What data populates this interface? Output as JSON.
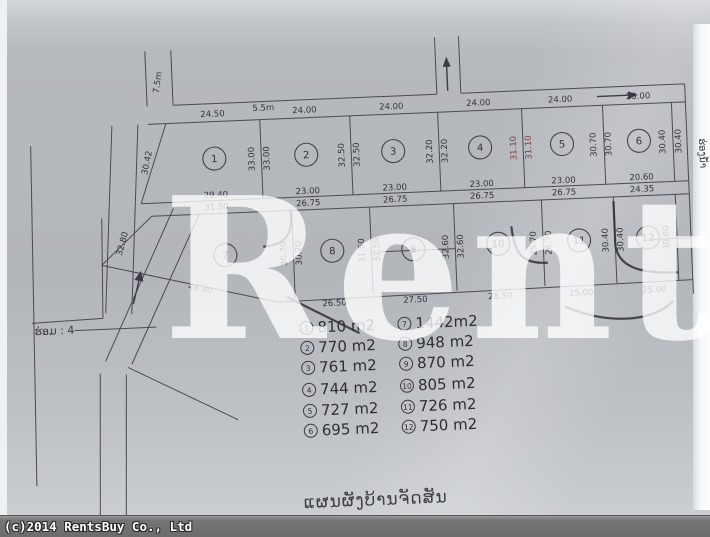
{
  "window": {
    "copyright": "(c)2014 RentsBuy Co., Ltd"
  },
  "watermark": {
    "text": "Rents"
  },
  "plan": {
    "caption": "ແຜນຜັງບ້ານຈັດສັນ",
    "alley_label": "ຮ່ອມ : 4",
    "canal_label": "ຮ່ອງນ້ຳ",
    "plot_numbers": [
      "1",
      "2",
      "3",
      "4",
      "5",
      "6",
      "7",
      "8",
      "9",
      "10",
      "11",
      "12"
    ],
    "dim_labels": [
      "7.5m",
      "24.50",
      "5.5m",
      "24.00",
      "24.00",
      "24.00",
      "24.00",
      "25.00",
      "30.42",
      "33.00",
      "33.00",
      "32.50",
      "32.50",
      "32.20",
      "32.20",
      "31.10",
      "31.10",
      "30.70",
      "30.70",
      "30.40",
      "30.40",
      "29.40",
      "31.50",
      "23.00",
      "26.75",
      "23.00",
      "26.75",
      "23.00",
      "26.75",
      "23.00",
      "26.75",
      "20.60",
      "24.35",
      "32.80",
      "30.70",
      "30.70",
      "31.50",
      "31.50",
      "32.60",
      "32.60",
      "25.70",
      "26.70",
      "30.40",
      "30.40",
      "30.60",
      "48.40",
      "26.50",
      "27.50",
      "28.50",
      "25.00",
      "25.00"
    ]
  },
  "legend": {
    "items": [
      {
        "no": "1",
        "area": "810 m2"
      },
      {
        "no": "2",
        "area": "770 m2"
      },
      {
        "no": "3",
        "area": "761 m2"
      },
      {
        "no": "4",
        "area": "744 m2"
      },
      {
        "no": "5",
        "area": "727 m2"
      },
      {
        "no": "6",
        "area": "695 m2"
      },
      {
        "no": "7",
        "area": "1442m2"
      },
      {
        "no": "8",
        "area": "948 m2"
      },
      {
        "no": "9",
        "area": "870 m2"
      },
      {
        "no": "10",
        "area": "805 m2"
      },
      {
        "no": "11",
        "area": "726 m2"
      },
      {
        "no": "12",
        "area": "750 m2"
      }
    ]
  },
  "colors": {
    "paper_line": "#4b4b52",
    "dim_text": "#33333b",
    "red_dim": "#7d4038",
    "watermark": "#ffffff",
    "bar_bg": "#6f6f6f"
  }
}
